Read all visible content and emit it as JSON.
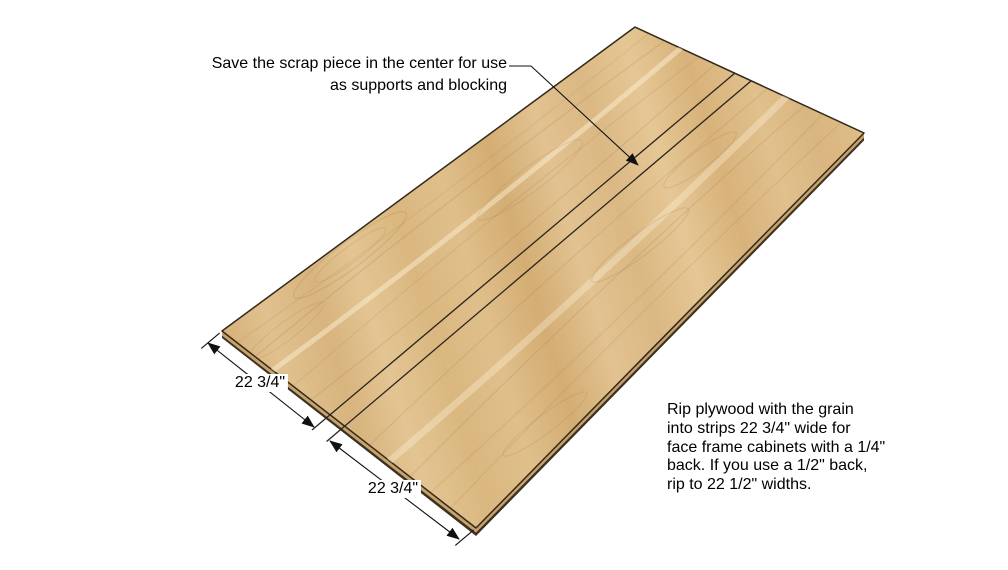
{
  "canvas": {
    "background": "#ffffff"
  },
  "callout": {
    "lines": [
      "Save the scrap piece in the center for use",
      "as supports and blocking"
    ]
  },
  "dimensions": {
    "front_strip_label": "22 3/4\"",
    "back_strip_label": "22 3/4\""
  },
  "note": {
    "lines": [
      "Rip plywood with the grain",
      "into strips 22 3/4\" wide for",
      "face frame cabinets with a 1/4\"",
      "back. If you use a 1/2\" back,",
      "rip to 22 1/2\" widths."
    ]
  },
  "colors": {
    "wood_face_base": "#dcba84",
    "wood_face_light": "#e5c795",
    "wood_face_dark": "#d3ad73",
    "wood_edge_tan": "#c9a26b",
    "wood_edge_dark": "#3f3120",
    "outline": "#33291b",
    "annotation_line": "#111111",
    "text": "#000000"
  }
}
